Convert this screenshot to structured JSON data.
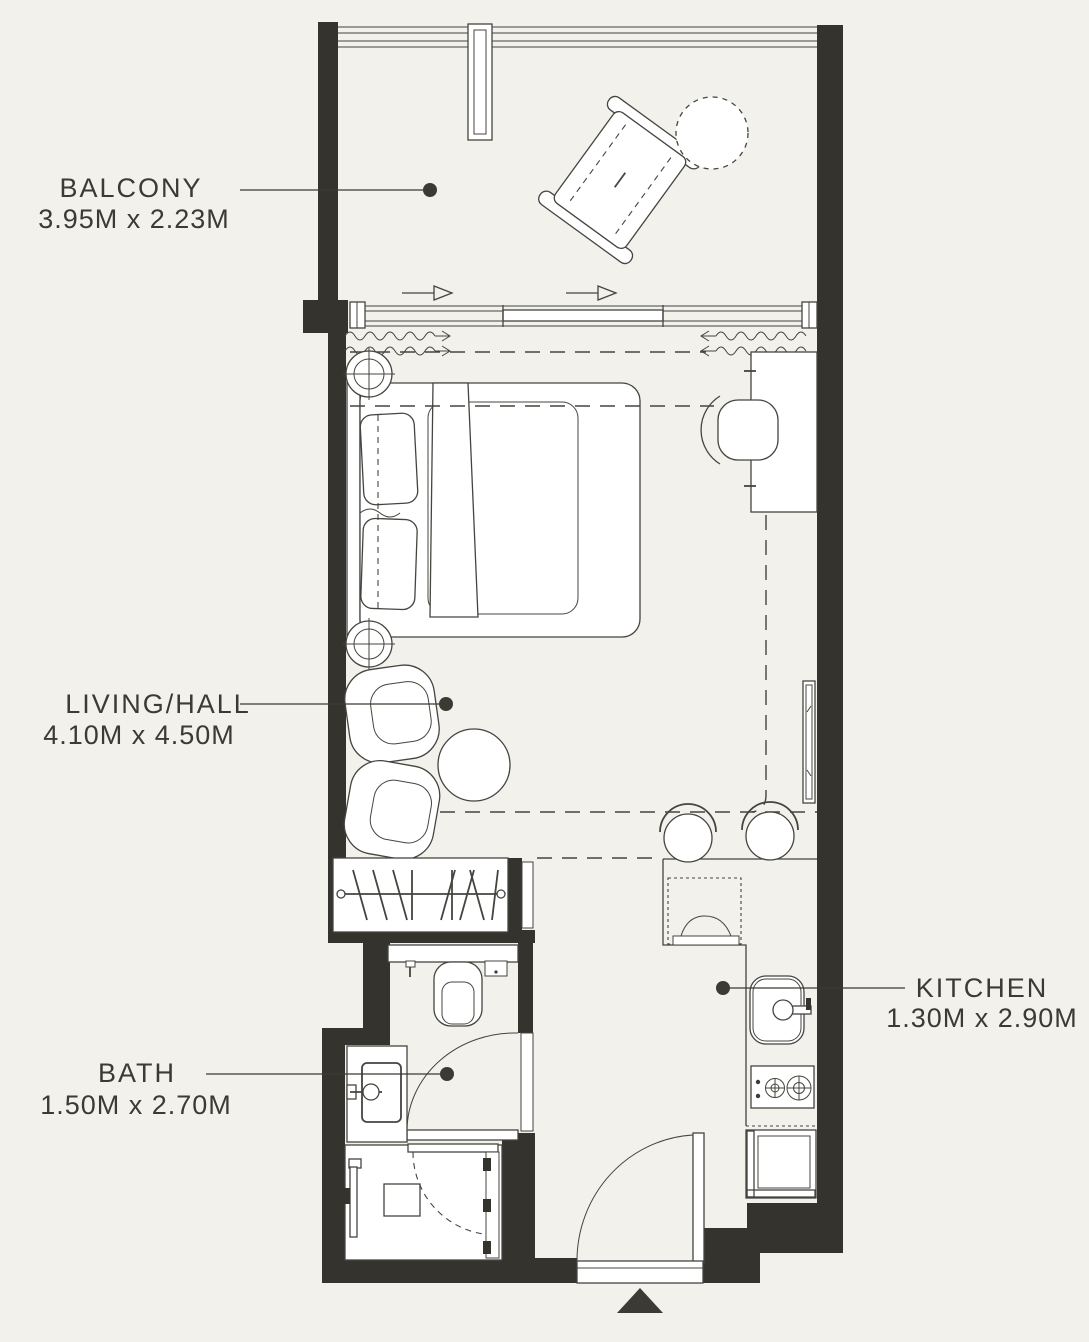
{
  "meta": {
    "title": "Studio apartment floor plan"
  },
  "colors": {
    "bg": "#f2f1ec",
    "wall": "#35332d",
    "line": "#45443f",
    "fill": "#ffffff",
    "ink": "#3b3a33"
  },
  "labels": {
    "balcony": {
      "name": "BALCONY",
      "dims": "3.95M x 2.23M"
    },
    "living": {
      "name": "LIVING/HALL",
      "dims": "4.10M x 4.50M"
    },
    "bath": {
      "name": "BATH",
      "dims": "1.50M x 2.70M"
    },
    "kitchen": {
      "name": "KITCHEN",
      "dims": "1.30M x 2.90M"
    }
  },
  "fixtures": [
    "lounge-chair-icon",
    "round-table-icon",
    "sliding-window-icon",
    "curtain-icon",
    "double-bed-icon",
    "ceiling-light-icon",
    "desk-icon",
    "desk-chair-icon",
    "armchair-icon",
    "coffee-table-icon",
    "wardrobe-icon",
    "tv-icon",
    "bar-stool-icon",
    "washing-machine-icon",
    "kitchen-sink-icon",
    "hob-icon",
    "fridge-icon",
    "toilet-icon",
    "wash-basin-icon",
    "shower-icon",
    "entry-door-icon",
    "entry-arrow-icon"
  ]
}
